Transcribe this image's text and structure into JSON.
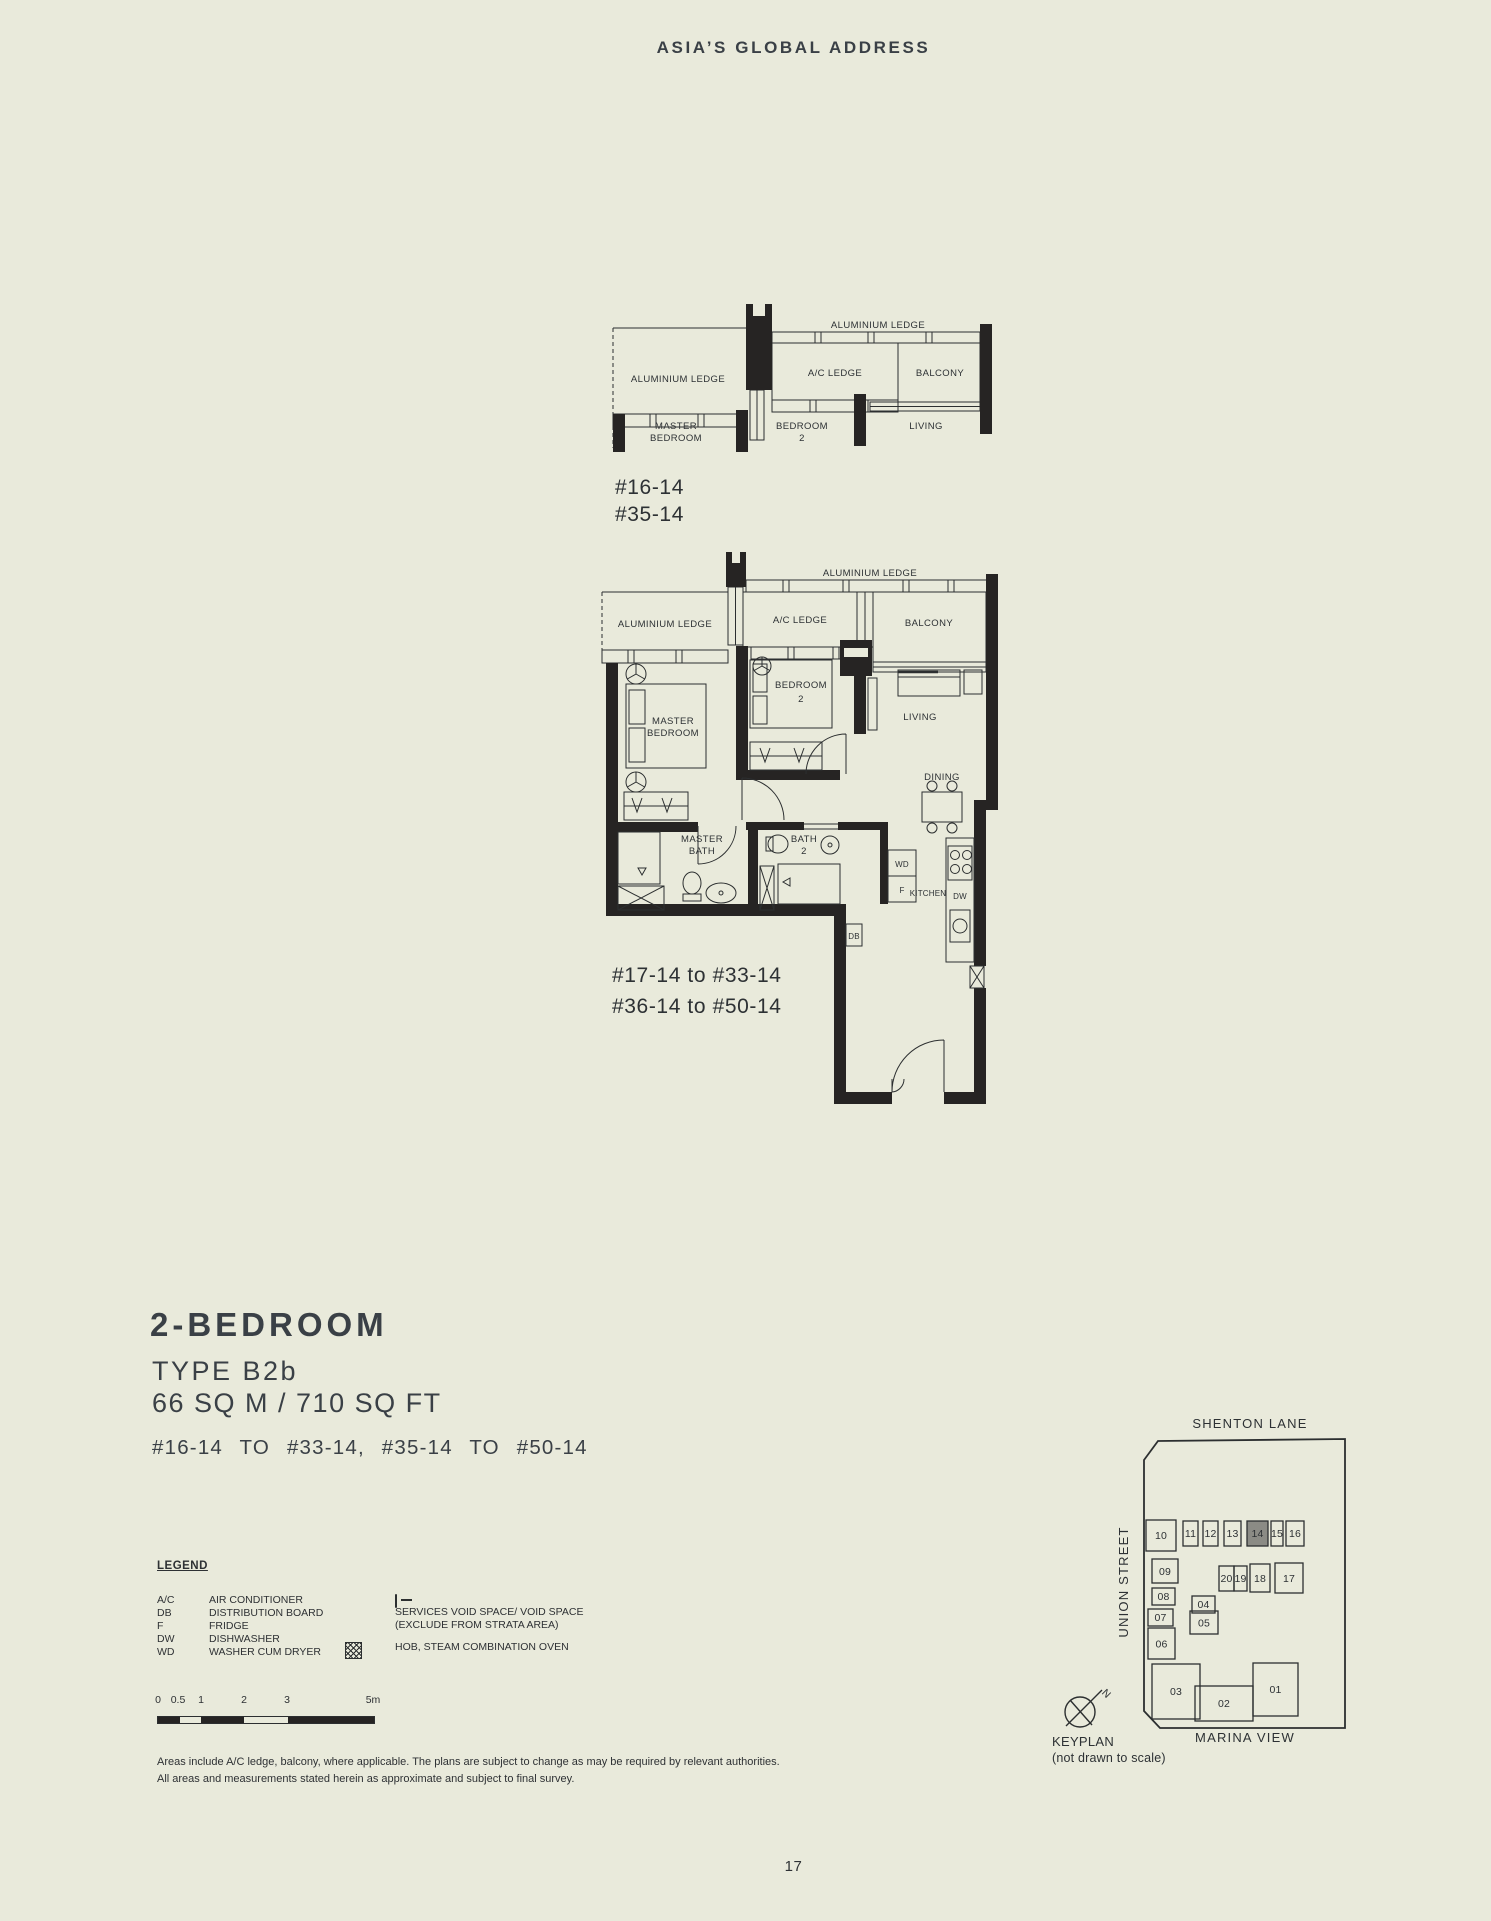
{
  "page": {
    "header": "ASIA’S GLOBAL ADDRESS",
    "page_number": "17",
    "colors": {
      "background": "#e9eadb",
      "ink": "#2e3134",
      "wall": "#262423",
      "title": "#3a4046",
      "keyplan_highlight": "#8b8b85"
    }
  },
  "section_plan": {
    "units": [
      "#16-14",
      "#35-14"
    ],
    "labels": {
      "ledge_left": "ALUMINIUM LEDGE",
      "ledge_top": "ALUMINIUM LEDGE",
      "ac_ledge": "A/C LEDGE",
      "balcony": "BALCONY",
      "master_l1": "MASTER",
      "master_l2": "BEDROOM",
      "bed2_l1": "BEDROOM",
      "bed2_l2": "2",
      "living": "LIVING"
    }
  },
  "floor_plan": {
    "units": [
      "#17-14 to #33-14",
      "#36-14 to #50-14"
    ],
    "labels": {
      "ledge_left": "ALUMINIUM LEDGE",
      "ledge_top": "ALUMINIUM LEDGE",
      "ac_ledge": "A/C LEDGE",
      "balcony": "BALCONY",
      "master_l1": "MASTER",
      "master_l2": "BEDROOM",
      "bed2_l1": "BEDROOM",
      "bed2_l2": "2",
      "living": "LIVING",
      "dining": "DINING",
      "master_bath_l1": "MASTER",
      "master_bath_l2": "BATH",
      "bath2_l1": "BATH",
      "bath2_l2": "2",
      "kitchen": "KITCHEN",
      "wd": "WD",
      "f": "F",
      "dw": "DW",
      "db": "DB"
    }
  },
  "title_block": {
    "name": "2-BEDROOM",
    "type": "TYPE B2b",
    "area": "66 SQ M / 710 SQ FT",
    "range": "#16-14 TO #33-14, #35-14 TO #50-14"
  },
  "legend": {
    "heading": "LEGEND",
    "abbreviations": [
      {
        "abbr": "A/C",
        "label": "AIR CONDITIONER"
      },
      {
        "abbr": "DB",
        "label": "DISTRIBUTION BOARD"
      },
      {
        "abbr": "F",
        "label": "FRIDGE"
      },
      {
        "abbr": "DW",
        "label": "DISHWASHER"
      },
      {
        "abbr": "WD",
        "label": "WASHER CUM DRYER"
      }
    ],
    "symbols": [
      {
        "icon": "services-void-icon",
        "line1": "SERVICES VOID SPACE/ VOID SPACE",
        "line2": "(EXCLUDE FROM STRATA AREA)"
      },
      {
        "icon": "hob-icon",
        "line1": "HOB, STEAM COMBINATION OVEN",
        "line2": ""
      }
    ]
  },
  "scale_bar": {
    "labels": [
      "0",
      "0.5",
      "1",
      "2",
      "3",
      "5m"
    ]
  },
  "disclaimer": {
    "line1": "Areas include A/C ledge, balcony, where applicable. The plans are subject to change as may be required by relevant authorities.",
    "line2": "All areas and measurements stated herein as approximate and subject to final survey."
  },
  "keyplan": {
    "street_top": "SHENTON LANE",
    "street_left": "UNION STREET",
    "street_bottom": "MARINA VIEW",
    "caption_line1": "KEYPLAN",
    "caption_line2": "(not drawn to scale)",
    "north_label": "N",
    "highlighted_unit": "14",
    "units": [
      "10",
      "11",
      "12",
      "13",
      "14",
      "15",
      "16",
      "20",
      "19",
      "18",
      "17",
      "09",
      "08",
      "04",
      "07",
      "05",
      "06",
      "03",
      "02",
      "01"
    ]
  }
}
